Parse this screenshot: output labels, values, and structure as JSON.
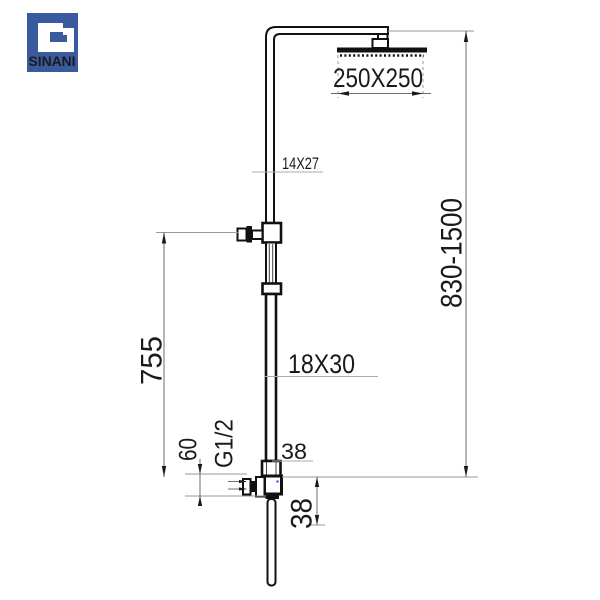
{
  "brand": {
    "name": "SINANI",
    "logo_color": "#3A5AA0"
  },
  "labels": {
    "head_size": "250X250",
    "upper_tube_section": "14X27",
    "lower_tube_section": "18X30",
    "height_range": "830-1500",
    "riser_height": "755",
    "inlet_offset": "60",
    "thread": "G1/2",
    "offset_top": "38",
    "offset_bottom": "38"
  }
}
